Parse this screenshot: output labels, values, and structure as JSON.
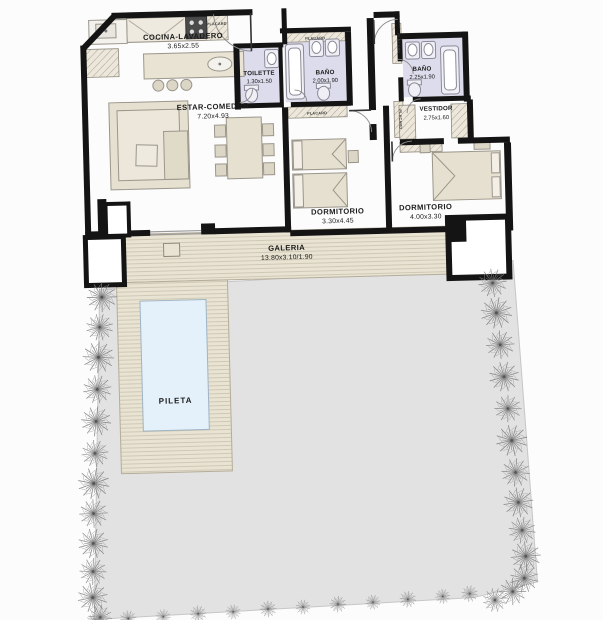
{
  "drawing": {
    "type": "architectural-floor-plan",
    "rooms": {
      "cocina": {
        "label": "COCINA-LAVADERO",
        "dims": "3.65x2.55"
      },
      "estar": {
        "label": "ESTAR-COMEDOR",
        "dims": "7.20x4.93"
      },
      "toilette": {
        "label": "TOILETTE",
        "dims": "1.30x1.50"
      },
      "bano1": {
        "label": "BAÑO",
        "dims": "2.00x1.90"
      },
      "bano2": {
        "label": "BAÑO",
        "dims": "2.25x1.90"
      },
      "vestidor": {
        "label": "VESTIDOR",
        "dims": "2.75x1.60"
      },
      "dorm1": {
        "label": "DORMITORIO",
        "dims": "3.30x4.45"
      },
      "dorm2": {
        "label": "DORMITORIO",
        "dims": "4.00x3.30"
      },
      "galeria": {
        "label": "GALERIA",
        "dims": "13.80x3.10/1.90"
      },
      "pileta": {
        "label": "PILETA"
      }
    },
    "annotations": {
      "placard": "PLACARD"
    },
    "icons": {
      "shrub": "starburst-plant-icon",
      "grass": "grass-tuft-icon"
    },
    "colors": {
      "wall": "#141414",
      "deck": "#e9e3d3",
      "deck_line": "#c9c1ad",
      "yard": "#e2e2e2",
      "yard_edge": "#c6c6c6",
      "pool": "#e4f1fa",
      "pool_edge": "#9fb4c4",
      "bath_floor": "#dcdcec",
      "furniture": "#e6e0d0",
      "furniture_edge": "#9b968b",
      "hatch_line": "#a9a294",
      "hatch_bg": "#ece7da",
      "plant": "#7b7b7b",
      "label": "#1b1b1b"
    }
  }
}
